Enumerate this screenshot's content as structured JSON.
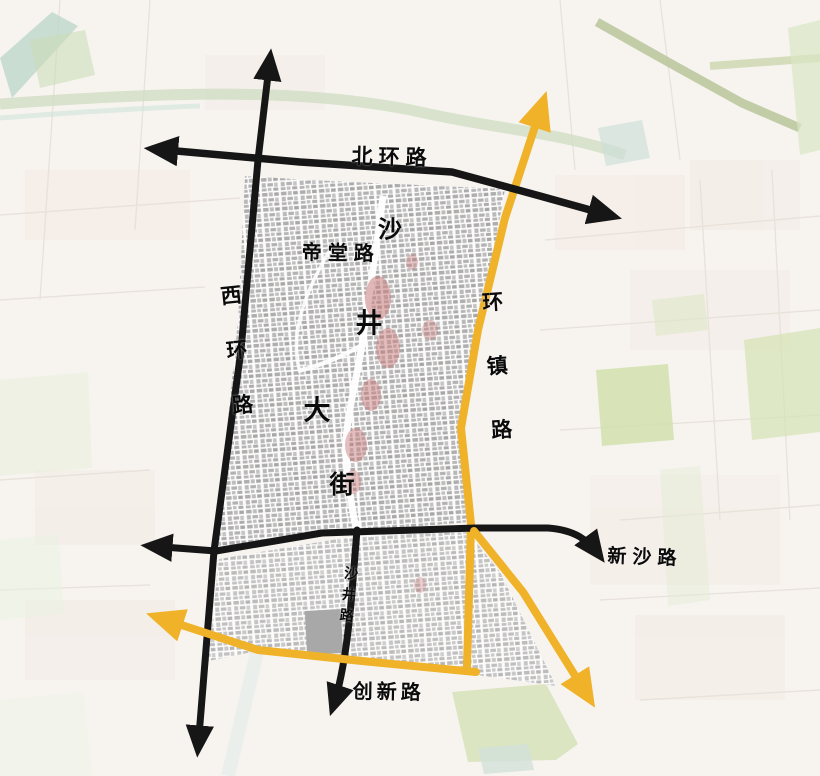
{
  "map": {
    "labels": {
      "beihuan": {
        "text": "北环路"
      },
      "xihuan": {
        "text": "西环路"
      },
      "huanzhen": {
        "text": "环镇路"
      },
      "ditang": {
        "text": "帝堂路"
      },
      "xinsha": {
        "text": "新沙路"
      },
      "shajinglu": {
        "text": "沙井路"
      },
      "chuangxin": {
        "text": "创新路"
      },
      "shajing_dajie": {
        "text": "沙井大街",
        "chars": [
          "沙",
          "井",
          "大",
          "街"
        ]
      }
    },
    "colors": {
      "primary_road_black": "#1a1a1a",
      "highlight_road_yellow": "#efb229",
      "historic_core_red": "#c97b7b",
      "oldtown_building_gray": "#a8a8a8",
      "park_green": "#d7e3bb",
      "water_teal": "#bcd9ce"
    }
  }
}
